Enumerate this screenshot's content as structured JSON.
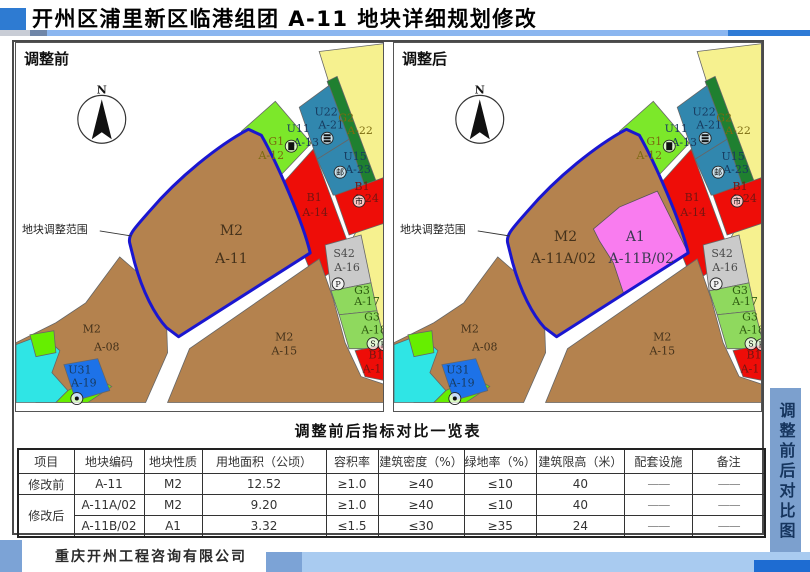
{
  "header": {
    "title": "开州区浦里新区临港组团 A-11 地块详细规划修改"
  },
  "panels": {
    "before_label": "调整前",
    "after_label": "调整后",
    "north_label": "N",
    "scope_label": "地块调整范围"
  },
  "map": {
    "colors": {
      "yellow": "#F6F18F",
      "brown": "#B4824E",
      "red": "#EE0D08",
      "bright_green": "#7CE82A",
      "teal": "#3187AE",
      "dark_green": "#1F8030",
      "pink": "#F97CEF",
      "gray": "#CACACA",
      "light_green": "#8FD95E",
      "blue_parcel": "#1D72E8",
      "cyan": "#2FE5E5",
      "lawn_green": "#66EE00",
      "boundary_blue": "#1A16D0"
    },
    "shared_labels": [
      {
        "t": "G1",
        "x": 261,
        "y": 102,
        "c": "olive"
      },
      {
        "t": "A-12",
        "x": 256,
        "y": 116,
        "c": "olive"
      },
      {
        "t": "U11",
        "x": 283,
        "y": 89,
        "c": "navy"
      },
      {
        "t": "A-13",
        "x": 291,
        "y": 103,
        "c": "navy"
      },
      {
        "t": "U22",
        "x": 311,
        "y": 72,
        "c": "navy"
      },
      {
        "t": "A-21",
        "x": 316,
        "y": 85,
        "c": "navy"
      },
      {
        "t": "G2",
        "x": 331,
        "y": 78,
        "c": "olive"
      },
      {
        "t": "A-22",
        "x": 345,
        "y": 91,
        "c": "olive"
      },
      {
        "t": "U15",
        "x": 340,
        "y": 117,
        "c": "navy"
      },
      {
        "t": "A-23",
        "x": 343,
        "y": 130,
        "c": "navy"
      },
      {
        "t": "B1",
        "x": 347,
        "y": 147,
        "c": "maroon"
      },
      {
        "t": "A-24",
        "x": 351,
        "y": 159,
        "c": "maroon"
      },
      {
        "t": "B1",
        "x": 299,
        "y": 158,
        "c": "maroon"
      },
      {
        "t": "A-14",
        "x": 300,
        "y": 173,
        "c": "maroon"
      },
      {
        "t": "S42",
        "x": 329,
        "y": 214,
        "c": "gray2"
      },
      {
        "t": "A-16",
        "x": 332,
        "y": 228,
        "c": "gray2"
      },
      {
        "t": "G3",
        "x": 347,
        "y": 251,
        "c": "dkg"
      },
      {
        "t": "A-17",
        "x": 352,
        "y": 262,
        "c": "dkg"
      },
      {
        "t": "G3",
        "x": 357,
        "y": 278,
        "c": "dkg"
      },
      {
        "t": "A-18",
        "x": 359,
        "y": 291,
        "c": "dkg"
      },
      {
        "t": "M2",
        "x": 76,
        "y": 290,
        "c": "brn"
      },
      {
        "t": "A-08",
        "x": 91,
        "y": 308,
        "c": "brn"
      },
      {
        "t": "U31",
        "x": 64,
        "y": 331,
        "c": "navy"
      },
      {
        "t": "A-19",
        "x": 68,
        "y": 344,
        "c": "navy"
      },
      {
        "t": "M2",
        "x": 269,
        "y": 298,
        "c": "brn"
      },
      {
        "t": "A-15",
        "x": 269,
        "y": 312,
        "c": "brn"
      },
      {
        "t": "B1",
        "x": 361,
        "y": 316,
        "c": "maroon"
      },
      {
        "t": "A-1",
        "x": 357,
        "y": 330,
        "c": "maroon"
      }
    ],
    "facility_icons": [
      {
        "name": "substation-icon",
        "type": "solid",
        "x": 276,
        "y": 103
      },
      {
        "name": "utility-icon",
        "type": "bars",
        "x": 312,
        "y": 95
      },
      {
        "name": "post-office-icon",
        "type": "char",
        "glyph": "邮",
        "x": 325,
        "y": 129
      },
      {
        "name": "market-icon",
        "type": "char",
        "glyph": "市",
        "x": 344,
        "y": 158
      },
      {
        "name": "parking-icon",
        "type": "char",
        "glyph": "P",
        "x": 323,
        "y": 241
      },
      {
        "name": "well-icon",
        "type": "dot",
        "x": 61,
        "y": 356
      },
      {
        "name": "s-facility-icon",
        "type": "char",
        "glyph": "S",
        "x": 358,
        "y": 301
      },
      {
        "name": "h-facility-icon",
        "type": "char",
        "glyph": "H",
        "x": 369,
        "y": 302
      }
    ],
    "before_labels": [
      {
        "t": "M2",
        "x": 216,
        "y": 192,
        "c": "brn",
        "s": 14
      },
      {
        "t": "A-11",
        "x": 216,
        "y": 220,
        "c": "brn",
        "s": 14
      }
    ],
    "after_labels": [
      {
        "t": "M2",
        "x": 172,
        "y": 198,
        "c": "brn",
        "s": 14
      },
      {
        "t": "A-11A/02",
        "x": 170,
        "y": 220,
        "c": "brn",
        "s": 14
      },
      {
        "t": "A1",
        "x": 242,
        "y": 198,
        "c": "dkb",
        "s": 14
      },
      {
        "t": "A-11B/02",
        "x": 248,
        "y": 220,
        "c": "dkb",
        "s": 14
      }
    ]
  },
  "comparison_table": {
    "title": "调整前后指标对比一览表",
    "headers": [
      "项目",
      "地块编码",
      "地块性质",
      "用地面积（公顷）",
      "容积率",
      "建筑密度（%）",
      "绿地率（%）",
      "建筑限高（米）",
      "配套设施",
      "备注"
    ],
    "rows": [
      {
        "item": "修改前",
        "rowspan": 1,
        "lines": [
          [
            "A-11",
            "M2",
            "12.52",
            "≥1.0",
            "≥40",
            "≤10",
            "40",
            "——",
            "——"
          ]
        ]
      },
      {
        "item": "修改后",
        "rowspan": 2,
        "lines": [
          [
            "A-11A/02",
            "M2",
            "9.20",
            "≥1.0",
            "≥40",
            "≤10",
            "40",
            "——",
            "——"
          ],
          [
            "A-11B/02",
            "A1",
            "3.32",
            "≤1.5",
            "≤30",
            "≥35",
            "24",
            "——",
            "——"
          ]
        ]
      }
    ]
  },
  "footer": {
    "company": "重庆开州工程咨询有限公司"
  },
  "sidebar": {
    "label": "调整前后对比图"
  }
}
